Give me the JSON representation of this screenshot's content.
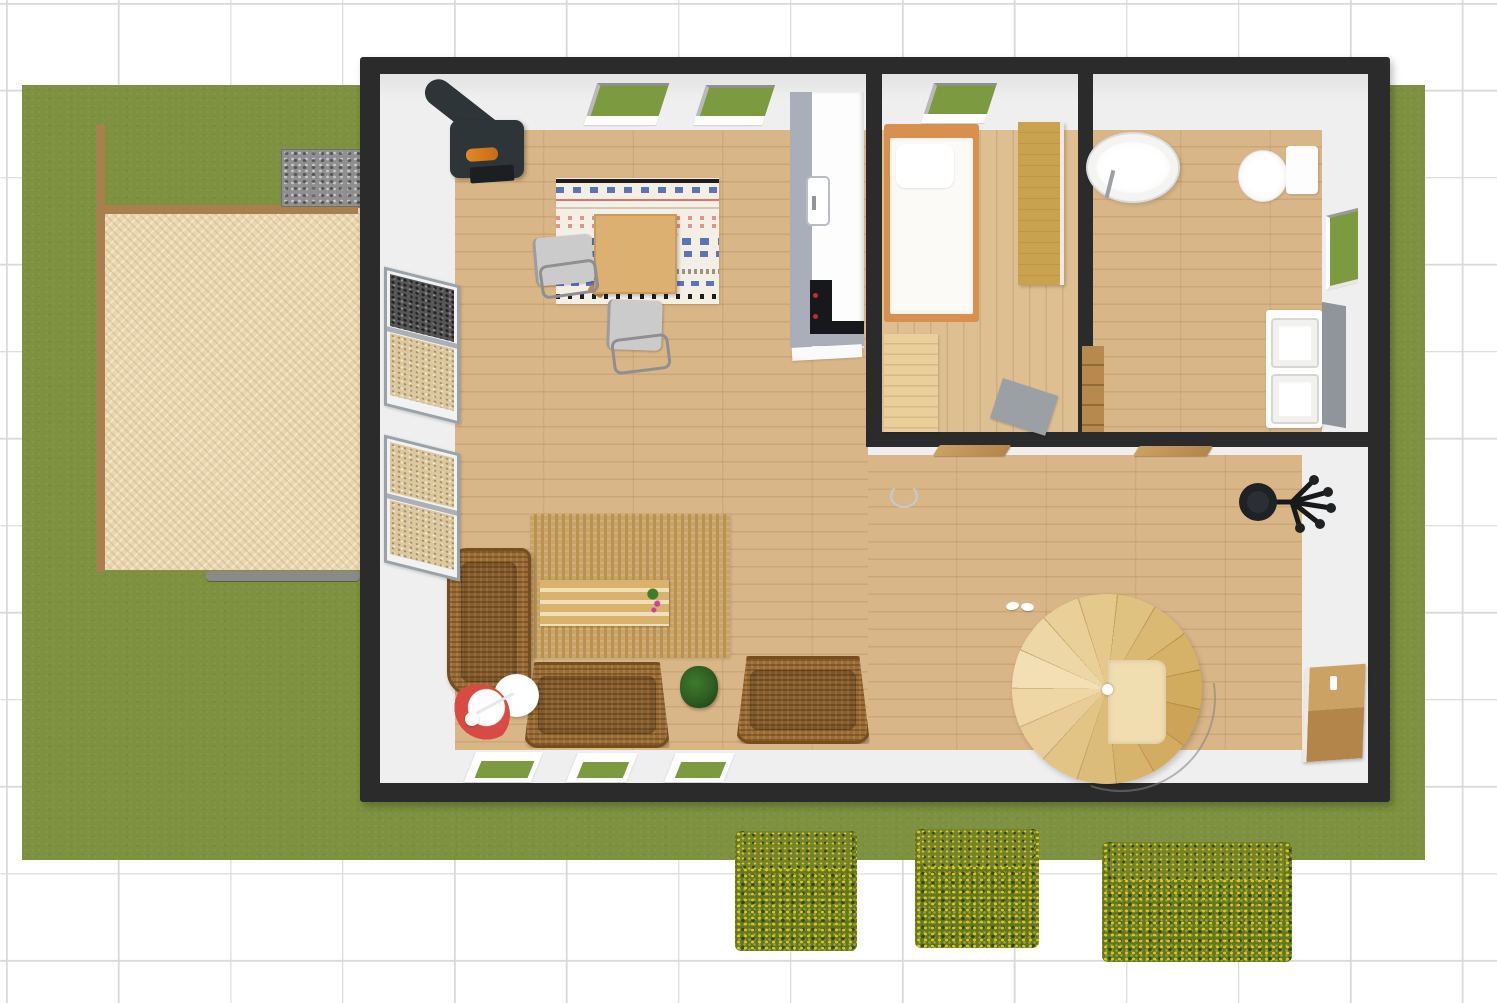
{
  "scene": {
    "label": "3D overhead floor plan of a small house with garden",
    "view_mode": "3D top-down"
  },
  "colors": {
    "grid_line": "#d9d9d9",
    "lawn": "#7d9140",
    "patio": "#ead7b0",
    "fence_brown": "#a7804e",
    "gabion_gray": "#8f8f8f",
    "plank_gray": "#8a8a8a",
    "wall_dark": "#2b2b2b",
    "interior_white": "#efefef",
    "floor_wood": "#d9b687",
    "floor_wood_light": "#ddbf92",
    "plank_shadow": "rgba(140,100,50,0.18)",
    "window_green": "#7c9a3f",
    "sill_white": "#ffffff",
    "counter_white": "#fdfdfd",
    "counter_gray": "#a9aeb9",
    "appliance_black": "#17181b",
    "knob_red": "#cc2a2a",
    "bed_frame_orange": "#d8904f",
    "mattress_white": "#fbfaf6",
    "wardrobe_wood": "#c9a24f",
    "dresser_wood": "#e8cf9b",
    "rug_gray": "#9aa0a4",
    "tub_white": "#ffffff",
    "vanity_gray": "#8f959b",
    "stove_body": "#2e3538",
    "rug_dining_bg": "#f4efe5",
    "rug_blue": "#5b74b8",
    "rug_red": "#d9756b",
    "rug_black": "#1c1c1c",
    "rug_jute": "#c9a369",
    "jute_stripe": "#b8934f",
    "wicker": "#9b6c33",
    "wicker_dark": "#744e1e",
    "bench_wood": "#d9b26c",
    "plant_green": "#2e5c22",
    "lamp_red": "#d84b44",
    "chair_gray": "#cbcbcb",
    "hedge_base": "#66761f",
    "hedge_top": "#75842a",
    "hedge_yellow": "#d9c81f",
    "hedge_dark": "#33491b",
    "marker_teal": "#bccfcf"
  },
  "outdoor": {
    "lawn": {
      "label": "Lawn"
    },
    "patio": {
      "label": "Gravel patio"
    },
    "fence_left": {
      "label": "Wooden fence (left)"
    },
    "fence_top": {
      "label": "Wooden fence (top)"
    },
    "gabion_wall": {
      "label": "Stone gabion wall"
    },
    "plank": {
      "label": "Wooden plank edge"
    },
    "hedge_1": {
      "label": "Flowering box hedge 1"
    },
    "hedge_2": {
      "label": "Flowering box hedge 2"
    },
    "hedge_3": {
      "label": "Flowering box hedge 3"
    }
  },
  "house": {
    "label": "House",
    "rooms": {
      "living": {
        "label": "Living / dining room"
      },
      "kitchen": {
        "label": "Kitchen"
      },
      "bedroom": {
        "label": "Bedroom"
      },
      "bathroom": {
        "label": "Bathroom"
      },
      "hallway": {
        "label": "Hallway"
      }
    },
    "windows": {
      "roof_window_1": {
        "label": "Roof window 1"
      },
      "roof_window_2": {
        "label": "Roof window 2"
      },
      "roof_window_3": {
        "label": "Bedroom roof window"
      },
      "bath_window": {
        "label": "Bathroom side window"
      },
      "floor_window_1": {
        "label": "South window 1"
      },
      "floor_window_2": {
        "label": "South window 2"
      },
      "floor_window_3": {
        "label": "South window 3"
      }
    },
    "doors": {
      "bedroom_door": {
        "label": "Bedroom door (open)"
      },
      "bathroom_door": {
        "label": "Bathroom door (open)"
      },
      "entry_door": {
        "label": "Entry door (open)"
      }
    }
  },
  "furniture": {
    "wood_stove": {
      "label": "Wood-burning stove with chimney"
    },
    "dining_rug": {
      "label": "Striped dining rug"
    },
    "dining_table": {
      "label": "Dining table"
    },
    "dining_chair_1": {
      "label": "Dining chair 1"
    },
    "dining_chair_2": {
      "label": "Dining chair 2"
    },
    "kitchen_counter": {
      "label": "Kitchen counter"
    },
    "kitchen_sink": {
      "label": "Kitchen sink"
    },
    "cooktop": {
      "label": "Cooktop / oven"
    },
    "bed": {
      "label": "Single bed"
    },
    "wardrobe": {
      "label": "Wardrobe"
    },
    "dresser": {
      "label": "Dresser"
    },
    "bedroom_rug": {
      "label": "Gray rug"
    },
    "bathtub": {
      "label": "Oval bathtub"
    },
    "toilet": {
      "label": "Toilet"
    },
    "vanity": {
      "label": "Double-sink vanity"
    },
    "bath_cabinet": {
      "label": "Bathroom cabinet"
    },
    "shelf_upper": {
      "label": "Firewood shelf (upper)"
    },
    "shelf_lower": {
      "label": "Firewood shelf (lower)"
    },
    "sofa_left": {
      "label": "Wicker sofa (left)"
    },
    "sofa_center": {
      "label": "Wicker sofa (center)"
    },
    "sofa_right": {
      "label": "Wicker sofa (right)"
    },
    "jute_rug": {
      "label": "Jute area rug"
    },
    "coffee_bench": {
      "label": "Slatted coffee bench"
    },
    "bench_flowers": {
      "label": "Flower decoration"
    },
    "potted_plant": {
      "label": "Potted plant"
    },
    "floor_lamp": {
      "label": "Red floor lamp"
    },
    "side_table": {
      "label": "Round side table"
    },
    "spiral_staircase": {
      "label": "Spiral staircase"
    },
    "office_chair": {
      "label": "Office chair"
    },
    "slippers": {
      "label": "Slippers"
    },
    "selection_marker": {
      "label": "Selection marker"
    }
  }
}
